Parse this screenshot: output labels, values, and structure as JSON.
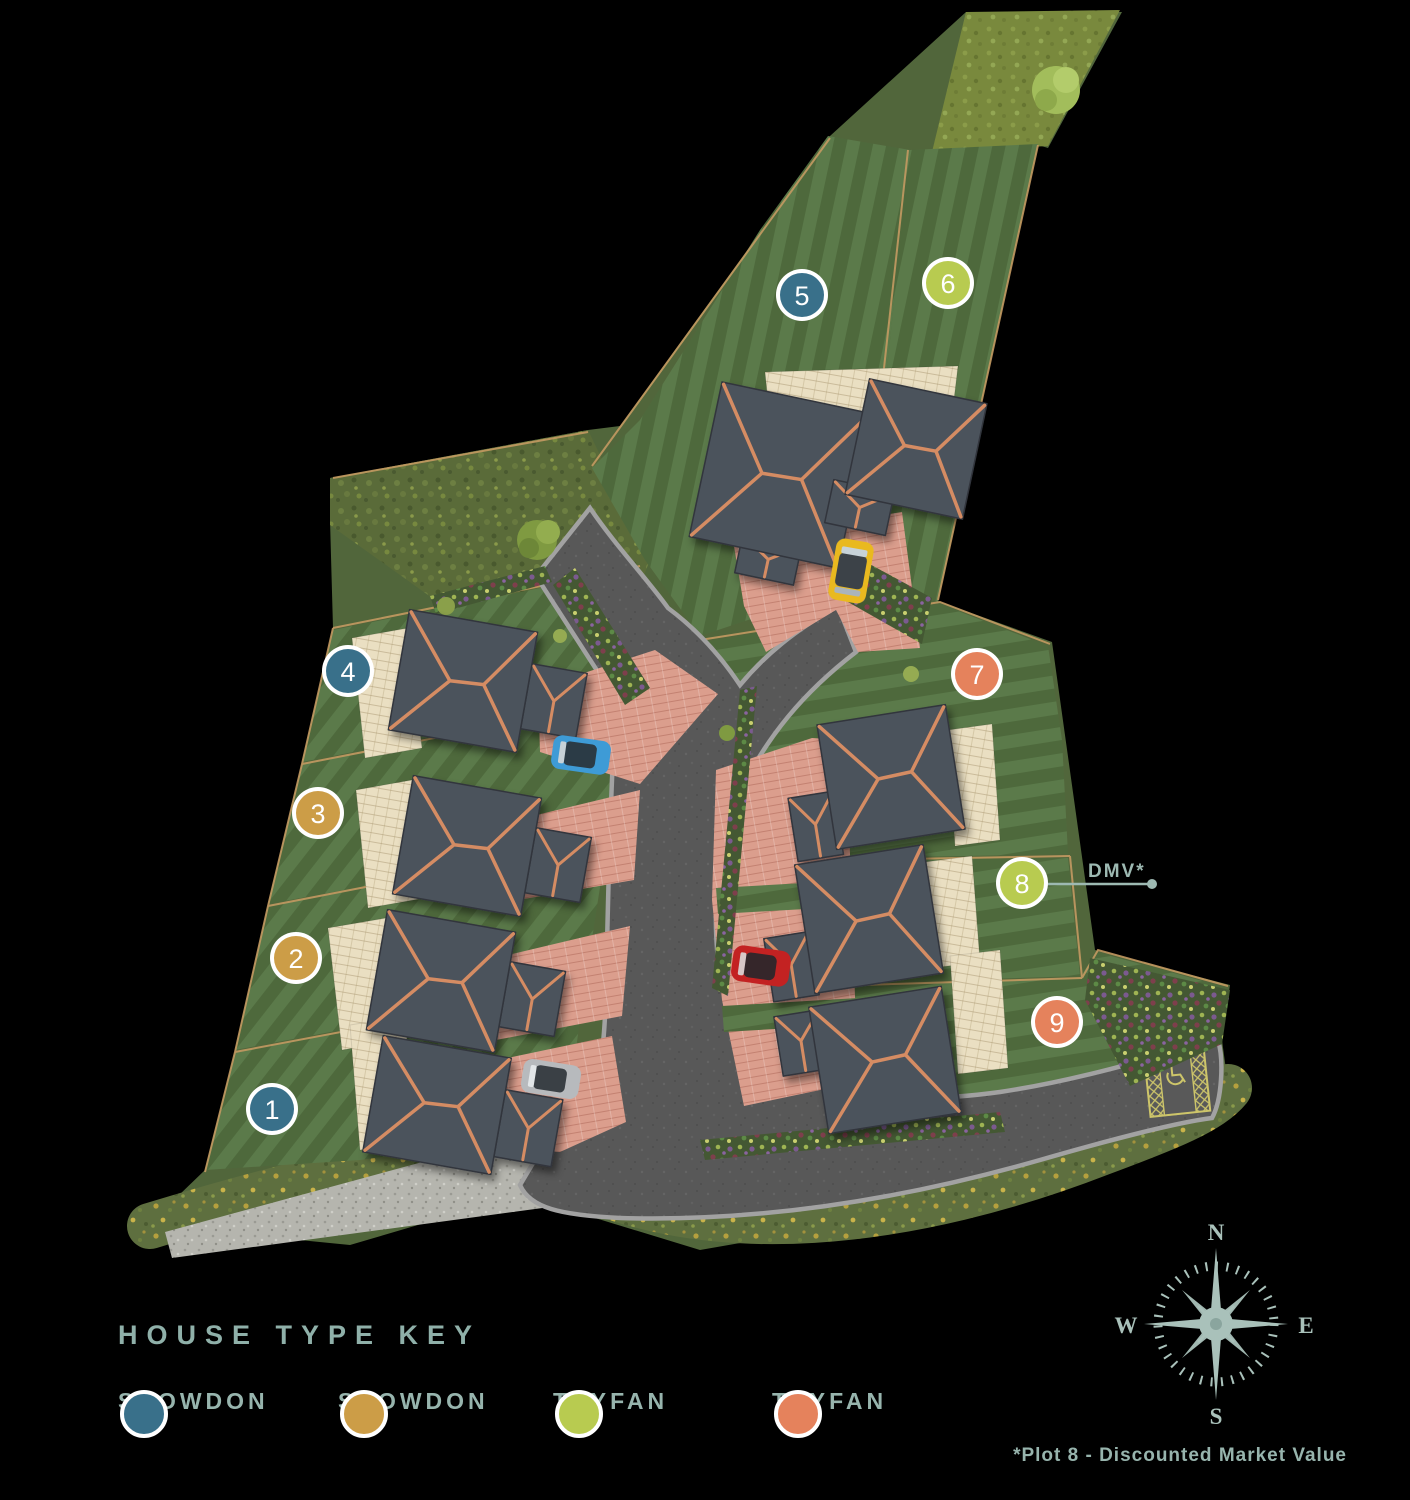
{
  "site_plan": {
    "dmv_label": "DMV*",
    "plots": [
      {
        "number": "1",
        "color": "#39708a"
      },
      {
        "number": "2",
        "color": "#cc9d47"
      },
      {
        "number": "3",
        "color": "#cc9d47"
      },
      {
        "number": "4",
        "color": "#39708a"
      },
      {
        "number": "5",
        "color": "#39708a"
      },
      {
        "number": "6",
        "color": "#b8cb50"
      },
      {
        "number": "7",
        "color": "#e5825c"
      },
      {
        "number": "8",
        "color": "#b8cb50"
      },
      {
        "number": "9",
        "color": "#e5825c"
      }
    ]
  },
  "legend": {
    "title": "HOUSE TYPE KEY",
    "items": [
      {
        "label": "SNOWDON",
        "color": "#39708a"
      },
      {
        "label": "SNOWDON",
        "color": "#cc9d47"
      },
      {
        "label": "TRYFAN",
        "color": "#b8cb50"
      },
      {
        "label": "TRYFAN",
        "color": "#e5825c"
      }
    ]
  },
  "compass": {
    "north": "N",
    "east": "E",
    "south": "S",
    "west": "W"
  },
  "footnote": "*Plot 8 - Discounted Market Value",
  "palette": {
    "text_sage": "#97b4ad",
    "compass_sage": "#a9c1ba",
    "road_asphalt": "#585858",
    "kerb": "#a2a2a2",
    "lawn_dark": "#4e693c",
    "lawn_light": "#5b7a4a",
    "driveway_pink": "#db9e8d",
    "patio_cream": "#eadfc2",
    "roof_grey": "#4c525b",
    "roof_ridge": "#d58c63"
  }
}
